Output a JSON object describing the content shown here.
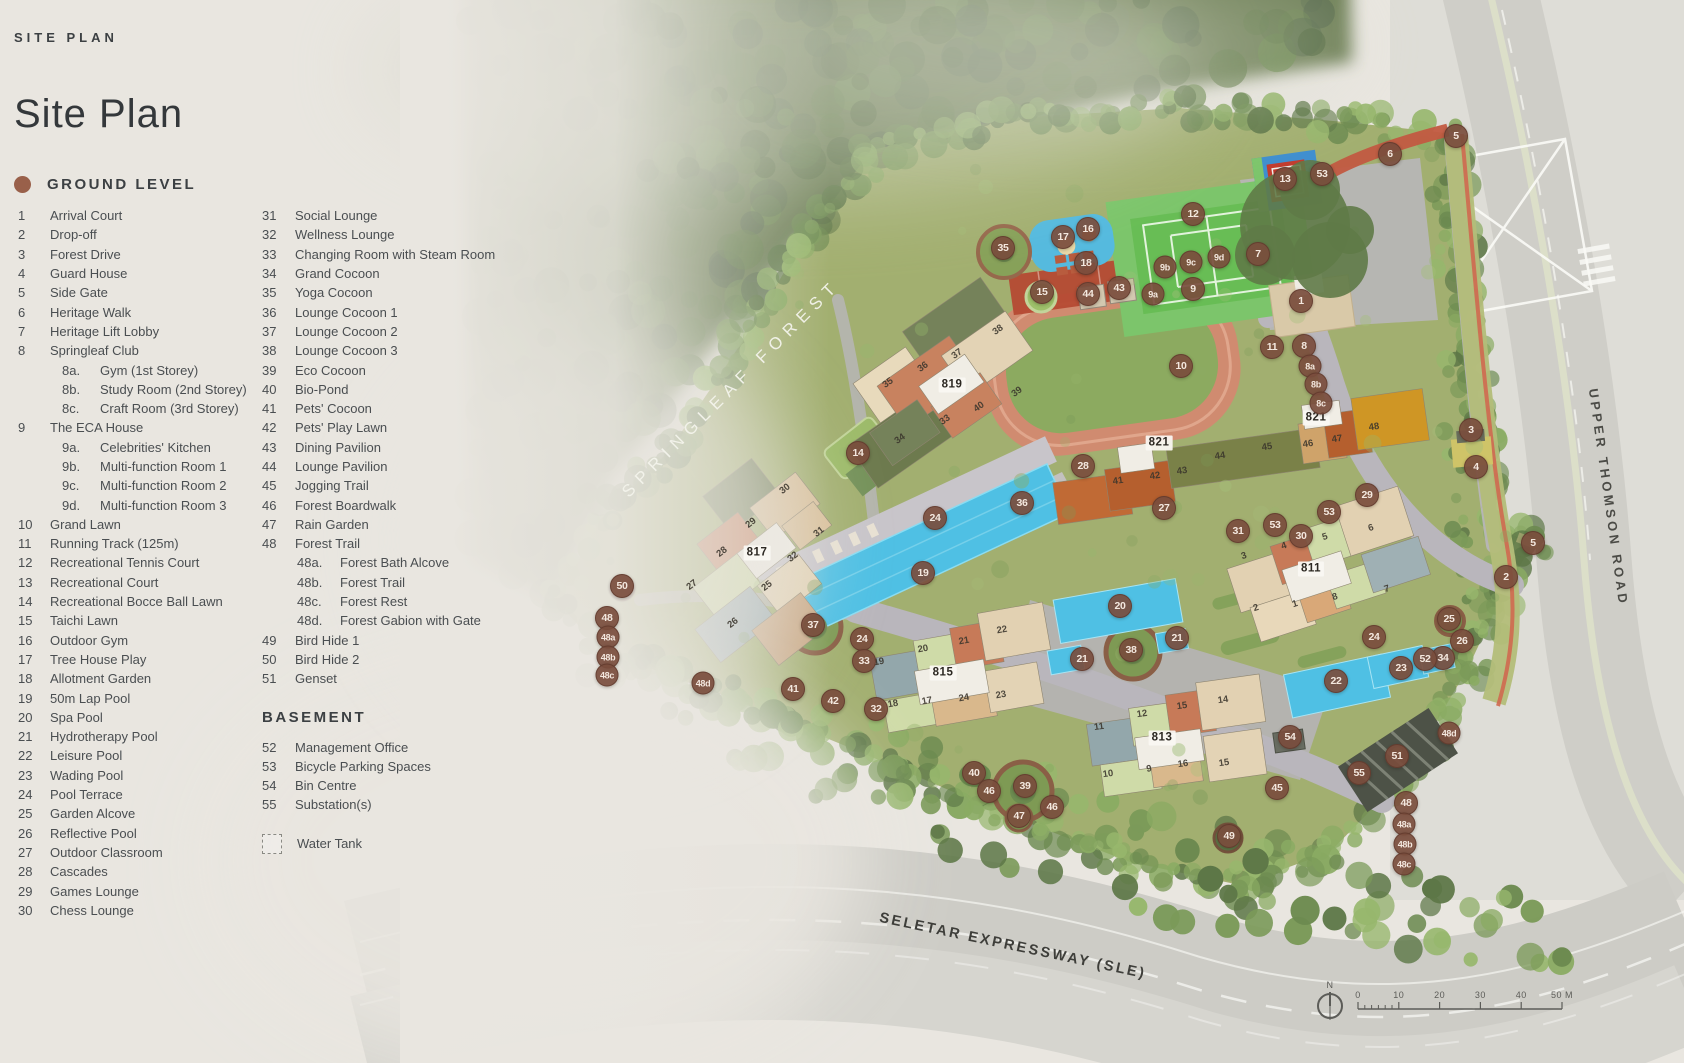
{
  "page": {
    "eyebrow": "SITE PLAN",
    "title": "Site Plan"
  },
  "legend": {
    "ground_heading": "GROUND LEVEL",
    "basement_heading": "BASEMENT",
    "water_tank_label": "Water Tank",
    "items": [
      {
        "n": "1",
        "label": "Arrival Court"
      },
      {
        "n": "2",
        "label": "Drop-off"
      },
      {
        "n": "3",
        "label": "Forest Drive"
      },
      {
        "n": "4",
        "label": "Guard House"
      },
      {
        "n": "5",
        "label": "Side Gate"
      },
      {
        "n": "6",
        "label": "Heritage Walk"
      },
      {
        "n": "7",
        "label": "Heritage Lift Lobby"
      },
      {
        "n": "8",
        "label": "Springleaf Club",
        "subs": [
          {
            "n": "8a.",
            "label": "Gym (1st Storey)"
          },
          {
            "n": "8b.",
            "label": "Study Room (2nd Storey)"
          },
          {
            "n": "8c.",
            "label": "Craft Room (3rd Storey)"
          }
        ]
      },
      {
        "n": "9",
        "label": "The ECA House",
        "subs": [
          {
            "n": "9a.",
            "label": "Celebrities' Kitchen"
          },
          {
            "n": "9b.",
            "label": "Multi-function Room 1"
          },
          {
            "n": "9c.",
            "label": "Multi-function Room 2"
          },
          {
            "n": "9d.",
            "label": "Multi-function Room 3"
          }
        ]
      },
      {
        "n": "10",
        "label": "Grand Lawn"
      },
      {
        "n": "11",
        "label": "Running Track (125m)"
      },
      {
        "n": "12",
        "label": "Recreational Tennis Court"
      },
      {
        "n": "13",
        "label": "Recreational Court"
      },
      {
        "n": "14",
        "label": "Recreational Bocce Ball Lawn"
      },
      {
        "n": "15",
        "label": "Taichi Lawn"
      },
      {
        "n": "16",
        "label": "Outdoor Gym"
      },
      {
        "n": "17",
        "label": "Tree House Play"
      },
      {
        "n": "18",
        "label": "Allotment Garden"
      },
      {
        "n": "19",
        "label": "50m Lap Pool"
      },
      {
        "n": "20",
        "label": "Spa Pool"
      },
      {
        "n": "21",
        "label": "Hydrotherapy Pool"
      },
      {
        "n": "22",
        "label": "Leisure Pool"
      },
      {
        "n": "23",
        "label": "Wading Pool"
      },
      {
        "n": "24",
        "label": "Pool Terrace"
      },
      {
        "n": "25",
        "label": "Garden Alcove"
      },
      {
        "n": "26",
        "label": "Reflective Pool"
      },
      {
        "n": "27",
        "label": "Outdoor Classroom"
      },
      {
        "n": "28",
        "label": "Cascades"
      },
      {
        "n": "29",
        "label": "Games Lounge"
      },
      {
        "n": "30",
        "label": "Chess Lounge"
      },
      {
        "n": "31",
        "label": "Social Lounge"
      },
      {
        "n": "32",
        "label": "Wellness Lounge"
      },
      {
        "n": "33",
        "label": "Changing Room with Steam Room"
      },
      {
        "n": "34",
        "label": "Grand Cocoon"
      },
      {
        "n": "35",
        "label": "Yoga Cocoon"
      },
      {
        "n": "36",
        "label": "Lounge Cocoon 1"
      },
      {
        "n": "37",
        "label": "Lounge Cocoon 2"
      },
      {
        "n": "38",
        "label": "Lounge Cocoon 3"
      },
      {
        "n": "39",
        "label": "Eco Cocoon"
      },
      {
        "n": "40",
        "label": "Bio-Pond"
      },
      {
        "n": "41",
        "label": "Pets' Cocoon"
      },
      {
        "n": "42",
        "label": "Pets' Play Lawn"
      },
      {
        "n": "43",
        "label": "Dining Pavilion"
      },
      {
        "n": "44",
        "label": "Lounge Pavilion"
      },
      {
        "n": "45",
        "label": "Jogging Trail"
      },
      {
        "n": "46",
        "label": "Forest Boardwalk"
      },
      {
        "n": "47",
        "label": "Rain Garden"
      },
      {
        "n": "48",
        "label": "Forest Trail",
        "subs": [
          {
            "n": "48a.",
            "label": "Forest Bath Alcove"
          },
          {
            "n": "48b.",
            "label": "Forest Trail"
          },
          {
            "n": "48c.",
            "label": "Forest Rest"
          },
          {
            "n": "48d.",
            "label": "Forest Gabion with Gate"
          }
        ]
      },
      {
        "n": "49",
        "label": "Bird Hide 1"
      },
      {
        "n": "50",
        "label": "Bird Hide 2"
      },
      {
        "n": "51",
        "label": "Genset"
      }
    ],
    "basement_items": [
      {
        "n": "52",
        "label": "Management Office"
      },
      {
        "n": "53",
        "label": "Bicycle Parking Spaces"
      },
      {
        "n": "54",
        "label": "Bin Centre"
      },
      {
        "n": "55",
        "label": "Substation(s)"
      }
    ]
  },
  "map": {
    "labels": {
      "forest": "SPRINGLEAF FOREST",
      "road_right": "UPPER THOMSON ROAD",
      "road_bottom": "SELETAR EXPRESSWAY (SLE)"
    },
    "building_labels": [
      {
        "t": "819",
        "x": 952,
        "y": 385
      },
      {
        "t": "817",
        "x": 757,
        "y": 553
      },
      {
        "t": "815",
        "x": 943,
        "y": 673
      },
      {
        "t": "813",
        "x": 1162,
        "y": 738
      },
      {
        "t": "811",
        "x": 1311,
        "y": 569
      },
      {
        "t": "821",
        "x": 1159,
        "y": 443
      },
      {
        "t": "821",
        "x": 1316,
        "y": 418
      }
    ],
    "unit_labels": [
      {
        "t": "36",
        "x": 923,
        "y": 367,
        "r": -35
      },
      {
        "t": "37",
        "x": 957,
        "y": 354,
        "r": -35
      },
      {
        "t": "38",
        "x": 998,
        "y": 330,
        "r": -35
      },
      {
        "t": "39",
        "x": 1017,
        "y": 392,
        "r": -35
      },
      {
        "t": "40",
        "x": 979,
        "y": 407,
        "r": -35
      },
      {
        "t": "33",
        "x": 945,
        "y": 420,
        "r": -35
      },
      {
        "t": "34",
        "x": 900,
        "y": 439,
        "r": -35
      },
      {
        "t": "35",
        "x": 888,
        "y": 383,
        "r": -35
      },
      {
        "t": "30",
        "x": 785,
        "y": 489,
        "r": -38
      },
      {
        "t": "29",
        "x": 751,
        "y": 523,
        "r": -38
      },
      {
        "t": "31",
        "x": 819,
        "y": 532,
        "r": -38
      },
      {
        "t": "28",
        "x": 722,
        "y": 552,
        "r": -38
      },
      {
        "t": "25",
        "x": 767,
        "y": 586,
        "r": -38
      },
      {
        "t": "27",
        "x": 692,
        "y": 585,
        "r": -38
      },
      {
        "t": "26",
        "x": 733,
        "y": 623,
        "r": -38
      },
      {
        "t": "32",
        "x": 793,
        "y": 557,
        "r": -38
      },
      {
        "t": "19",
        "x": 879,
        "y": 662,
        "r": -10
      },
      {
        "t": "20",
        "x": 923,
        "y": 649,
        "r": -10
      },
      {
        "t": "21",
        "x": 964,
        "y": 641,
        "r": -10
      },
      {
        "t": "22",
        "x": 1002,
        "y": 630,
        "r": -10
      },
      {
        "t": "23",
        "x": 1001,
        "y": 695,
        "r": -10
      },
      {
        "t": "24",
        "x": 964,
        "y": 698,
        "r": -10
      },
      {
        "t": "17",
        "x": 927,
        "y": 701,
        "r": -10
      },
      {
        "t": "18",
        "x": 893,
        "y": 704,
        "r": -10
      },
      {
        "t": "11",
        "x": 1099,
        "y": 727,
        "r": -8
      },
      {
        "t": "12",
        "x": 1142,
        "y": 714,
        "r": -8
      },
      {
        "t": "15",
        "x": 1182,
        "y": 706,
        "r": -8
      },
      {
        "t": "14",
        "x": 1223,
        "y": 700,
        "r": -8
      },
      {
        "t": "10",
        "x": 1108,
        "y": 774,
        "r": -8
      },
      {
        "t": "9",
        "x": 1149,
        "y": 769,
        "r": -8
      },
      {
        "t": "16",
        "x": 1183,
        "y": 764,
        "r": -8
      },
      {
        "t": "15",
        "x": 1224,
        "y": 763,
        "r": -8
      },
      {
        "t": "3",
        "x": 1244,
        "y": 556,
        "r": -18
      },
      {
        "t": "4",
        "x": 1284,
        "y": 546,
        "r": -18
      },
      {
        "t": "5",
        "x": 1325,
        "y": 537,
        "r": -18
      },
      {
        "t": "6",
        "x": 1371,
        "y": 528,
        "r": -18
      },
      {
        "t": "2",
        "x": 1256,
        "y": 608,
        "r": -18
      },
      {
        "t": "1",
        "x": 1295,
        "y": 604,
        "r": -18
      },
      {
        "t": "8",
        "x": 1335,
        "y": 597,
        "r": -18
      },
      {
        "t": "7",
        "x": 1387,
        "y": 589,
        "r": -18
      },
      {
        "t": "41",
        "x": 1118,
        "y": 481,
        "r": -8
      },
      {
        "t": "42",
        "x": 1155,
        "y": 476,
        "r": -8
      },
      {
        "t": "43",
        "x": 1182,
        "y": 471,
        "r": -8
      },
      {
        "t": "44",
        "x": 1220,
        "y": 456,
        "r": -8
      },
      {
        "t": "45",
        "x": 1267,
        "y": 447,
        "r": -8
      },
      {
        "t": "46",
        "x": 1308,
        "y": 444,
        "r": -8
      },
      {
        "t": "47",
        "x": 1337,
        "y": 439,
        "r": -8
      },
      {
        "t": "48",
        "x": 1374,
        "y": 427,
        "r": -8
      }
    ],
    "markers": [
      {
        "n": "1",
        "x": 1301,
        "y": 301
      },
      {
        "n": "2",
        "x": 1506,
        "y": 577
      },
      {
        "n": "3",
        "x": 1471,
        "y": 430
      },
      {
        "n": "4",
        "x": 1476,
        "y": 467
      },
      {
        "n": "5",
        "x": 1456,
        "y": 136
      },
      {
        "n": "5",
        "x": 1533,
        "y": 543
      },
      {
        "n": "6",
        "x": 1390,
        "y": 154
      },
      {
        "n": "7",
        "x": 1258,
        "y": 254
      },
      {
        "n": "8",
        "x": 1304,
        "y": 346
      },
      {
        "n": "8a",
        "x": 1310,
        "y": 366
      },
      {
        "n": "8b",
        "x": 1316,
        "y": 384
      },
      {
        "n": "8c",
        "x": 1321,
        "y": 403
      },
      {
        "n": "9",
        "x": 1193,
        "y": 289
      },
      {
        "n": "9a",
        "x": 1153,
        "y": 294
      },
      {
        "n": "9b",
        "x": 1165,
        "y": 267
      },
      {
        "n": "9c",
        "x": 1191,
        "y": 262
      },
      {
        "n": "9d",
        "x": 1219,
        "y": 257
      },
      {
        "n": "10",
        "x": 1181,
        "y": 366
      },
      {
        "n": "11",
        "x": 1272,
        "y": 347
      },
      {
        "n": "12",
        "x": 1193,
        "y": 214
      },
      {
        "n": "13",
        "x": 1285,
        "y": 179
      },
      {
        "n": "14",
        "x": 858,
        "y": 453
      },
      {
        "n": "15",
        "x": 1042,
        "y": 292
      },
      {
        "n": "16",
        "x": 1088,
        "y": 229
      },
      {
        "n": "17",
        "x": 1063,
        "y": 237
      },
      {
        "n": "18",
        "x": 1086,
        "y": 263
      },
      {
        "n": "19",
        "x": 923,
        "y": 573
      },
      {
        "n": "20",
        "x": 1120,
        "y": 606
      },
      {
        "n": "21",
        "x": 1082,
        "y": 659
      },
      {
        "n": "21",
        "x": 1177,
        "y": 638
      },
      {
        "n": "22",
        "x": 1336,
        "y": 681
      },
      {
        "n": "23",
        "x": 1401,
        "y": 668
      },
      {
        "n": "24",
        "x": 935,
        "y": 518
      },
      {
        "n": "24",
        "x": 862,
        "y": 639
      },
      {
        "n": "24",
        "x": 1374,
        "y": 637
      },
      {
        "n": "25",
        "x": 1449,
        "y": 619
      },
      {
        "n": "26",
        "x": 1462,
        "y": 641
      },
      {
        "n": "27",
        "x": 1164,
        "y": 508
      },
      {
        "n": "28",
        "x": 1083,
        "y": 466
      },
      {
        "n": "29",
        "x": 1367,
        "y": 495
      },
      {
        "n": "30",
        "x": 1301,
        "y": 536
      },
      {
        "n": "31",
        "x": 1238,
        "y": 531
      },
      {
        "n": "32",
        "x": 876,
        "y": 709
      },
      {
        "n": "33",
        "x": 864,
        "y": 661
      },
      {
        "n": "34",
        "x": 1443,
        "y": 658
      },
      {
        "n": "35",
        "x": 1003,
        "y": 248
      },
      {
        "n": "36",
        "x": 1022,
        "y": 503
      },
      {
        "n": "37",
        "x": 813,
        "y": 625
      },
      {
        "n": "38",
        "x": 1131,
        "y": 650
      },
      {
        "n": "39",
        "x": 1025,
        "y": 786
      },
      {
        "n": "40",
        "x": 974,
        "y": 773
      },
      {
        "n": "41",
        "x": 793,
        "y": 689
      },
      {
        "n": "42",
        "x": 833,
        "y": 701
      },
      {
        "n": "43",
        "x": 1119,
        "y": 288
      },
      {
        "n": "44",
        "x": 1088,
        "y": 294
      },
      {
        "n": "45",
        "x": 1277,
        "y": 788
      },
      {
        "n": "46",
        "x": 989,
        "y": 791
      },
      {
        "n": "46",
        "x": 1052,
        "y": 807
      },
      {
        "n": "47",
        "x": 1019,
        "y": 816
      },
      {
        "n": "48",
        "x": 607,
        "y": 618
      },
      {
        "n": "48a",
        "x": 608,
        "y": 637
      },
      {
        "n": "48b",
        "x": 608,
        "y": 657
      },
      {
        "n": "48c",
        "x": 607,
        "y": 675
      },
      {
        "n": "48d",
        "x": 703,
        "y": 683
      },
      {
        "n": "48",
        "x": 1406,
        "y": 803
      },
      {
        "n": "48a",
        "x": 1404,
        "y": 824
      },
      {
        "n": "48b",
        "x": 1405,
        "y": 844
      },
      {
        "n": "48c",
        "x": 1404,
        "y": 864
      },
      {
        "n": "48d",
        "x": 1449,
        "y": 733
      },
      {
        "n": "49",
        "x": 1229,
        "y": 836
      },
      {
        "n": "50",
        "x": 622,
        "y": 586
      },
      {
        "n": "51",
        "x": 1397,
        "y": 756
      },
      {
        "n": "52",
        "x": 1425,
        "y": 659
      },
      {
        "n": "53",
        "x": 1322,
        "y": 174
      },
      {
        "n": "53",
        "x": 1329,
        "y": 512
      },
      {
        "n": "53",
        "x": 1275,
        "y": 525
      },
      {
        "n": "54",
        "x": 1290,
        "y": 737
      },
      {
        "n": "55",
        "x": 1359,
        "y": 773
      }
    ],
    "scale": {
      "north_label": "N",
      "tick_labels": [
        "0",
        "10",
        "20",
        "30",
        "40",
        "50 M"
      ]
    }
  },
  "colors": {
    "marker": "#7a4d3d",
    "legend_dot": "#99604a",
    "pool": "#4fc0e4",
    "track": "#d08b70",
    "court_green": "#6abf58",
    "accent_red": "#c25a41",
    "background": "#e9e6e0"
  }
}
